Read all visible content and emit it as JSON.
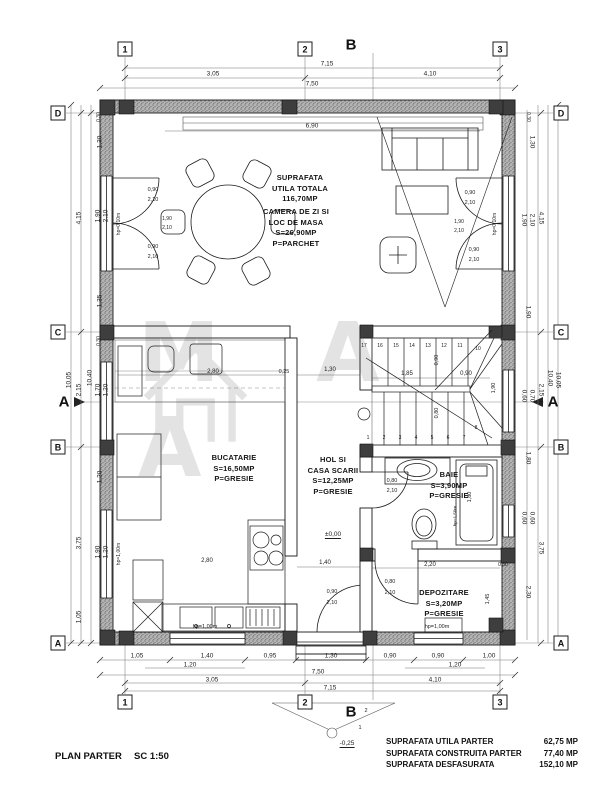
{
  "titleblock": {
    "plan_title": "PLAN PARTER",
    "scale_label": "SC 1:50"
  },
  "summary": {
    "rows": [
      {
        "label": "SUPRAFATA UTILA  PARTER",
        "value": "62,75 MP"
      },
      {
        "label": "SUPRAFATA CONSTRUITA  PARTER",
        "value": "77,40 MP"
      },
      {
        "label": "SUPRAFATA DESFASURATA",
        "value": "152,10 MP"
      }
    ]
  },
  "watermark": {
    "text": "M A A"
  },
  "rooms": [
    {
      "id": "total-area",
      "x": 300,
      "y": 173,
      "lines": [
        "SUPRAFATA",
        "UTILA TOTALA",
        "116,70MP"
      ]
    },
    {
      "id": "living",
      "x": 296,
      "y": 207,
      "lines": [
        "CAMERA DE ZI SI",
        "LOC DE MASA",
        "S=26,90MP",
        "P=PARCHET"
      ]
    },
    {
      "id": "kitchen",
      "x": 234,
      "y": 453,
      "lines": [
        "BUCATARIE",
        "S=16,50MP",
        "P=GRESIE"
      ]
    },
    {
      "id": "hall",
      "x": 333,
      "y": 455,
      "lines": [
        "HOL SI",
        "CASA SCARII",
        "S=12,25MP",
        "P=GRESIE"
      ]
    },
    {
      "id": "bathroom",
      "x": 449,
      "y": 470,
      "lines": [
        "BAIE",
        "S=3,90MP",
        "P=GRESIE"
      ]
    },
    {
      "id": "storage",
      "x": 444,
      "y": 588,
      "lines": [
        "DEPOZITARE",
        "S=3,20MP",
        "P=GRESIE"
      ]
    }
  ],
  "grid_markers": [
    {
      "t": "1",
      "x": 125,
      "y": 49
    },
    {
      "t": "2",
      "x": 305,
      "y": 49
    },
    {
      "t": "3",
      "x": 500,
      "y": 49
    },
    {
      "t": "1",
      "x": 125,
      "y": 702
    },
    {
      "t": "2",
      "x": 305,
      "y": 702
    },
    {
      "t": "3",
      "x": 500,
      "y": 702
    },
    {
      "t": "D",
      "x": 58,
      "y": 113
    },
    {
      "t": "C",
      "x": 58,
      "y": 332
    },
    {
      "t": "B",
      "x": 58,
      "y": 447
    },
    {
      "t": "A",
      "x": 58,
      "y": 643
    },
    {
      "t": "D",
      "x": 561,
      "y": 113
    },
    {
      "t": "C",
      "x": 561,
      "y": 332
    },
    {
      "t": "B",
      "x": 561,
      "y": 447
    },
    {
      "t": "A",
      "x": 561,
      "y": 643
    },
    {
      "t": "B",
      "x": 351,
      "y": 45,
      "bold": true
    },
    {
      "t": "B",
      "x": 351,
      "y": 712,
      "bold": true
    },
    {
      "t": "A",
      "x": 64,
      "y": 402,
      "bold": true
    },
    {
      "t": "A",
      "x": 553,
      "y": 402,
      "bold": true
    }
  ],
  "dim_labels": [
    {
      "t": "7,15",
      "x": 327,
      "y": 64
    },
    {
      "t": "3,05",
      "x": 213,
      "y": 74
    },
    {
      "t": "4,10",
      "x": 430,
      "y": 74
    },
    {
      "t": "7,50",
      "x": 312,
      "y": 84
    },
    {
      "t": "6,90",
      "x": 312,
      "y": 126
    },
    {
      "t": "1,05",
      "x": 137,
      "y": 656
    },
    {
      "t": "1,40",
      "x": 207,
      "y": 656
    },
    {
      "t": "0,95",
      "x": 270,
      "y": 656
    },
    {
      "t": "1,30",
      "x": 331,
      "y": 656
    },
    {
      "t": "0,90",
      "x": 390,
      "y": 656
    },
    {
      "t": "0,90",
      "x": 438,
      "y": 656
    },
    {
      "t": "1,00",
      "x": 489,
      "y": 656
    },
    {
      "t": "1,20",
      "x": 190,
      "y": 665
    },
    {
      "t": "1,20",
      "x": 455,
      "y": 665
    },
    {
      "t": "7,50",
      "x": 318,
      "y": 672
    },
    {
      "t": "3,05",
      "x": 212,
      "y": 680
    },
    {
      "t": "4,10",
      "x": 435,
      "y": 680
    },
    {
      "t": "7,15",
      "x": 330,
      "y": 688
    },
    {
      "t": "2",
      "x": 366,
      "y": 711,
      "s": 5.5
    },
    {
      "t": "1",
      "x": 360,
      "y": 728,
      "s": 5.5
    },
    {
      "t": "-0,25",
      "x": 347,
      "y": 744,
      "u": true
    },
    {
      "t": "10,05",
      "x": 69,
      "y": 380,
      "r": -90
    },
    {
      "t": "4,15",
      "x": 79,
      "y": 218,
      "r": -90
    },
    {
      "t": "2,15",
      "x": 79,
      "y": 390,
      "r": -90
    },
    {
      "t": "3,75",
      "x": 79,
      "y": 543,
      "r": -90
    },
    {
      "t": "1,05",
      "x": 79,
      "y": 617,
      "r": -90
    },
    {
      "t": "10,40",
      "x": 90,
      "y": 378,
      "r": -90
    },
    {
      "t": "1,30",
      "x": 100,
      "y": 142,
      "r": -90
    },
    {
      "t": "1,90",
      "x": 98,
      "y": 216,
      "r": -90
    },
    {
      "t": "2,10",
      "x": 106,
      "y": 216,
      "r": -90
    },
    {
      "t": "1,35",
      "x": 100,
      "y": 301,
      "r": -90
    },
    {
      "t": "1,70",
      "x": 98,
      "y": 390,
      "r": -90
    },
    {
      "t": "1,20",
      "x": 106,
      "y": 390,
      "r": -90
    },
    {
      "t": "1,20",
      "x": 100,
      "y": 477,
      "r": -90
    },
    {
      "t": "1,90",
      "x": 98,
      "y": 552,
      "r": -90
    },
    {
      "t": "1,20",
      "x": 106,
      "y": 552,
      "r": -90
    },
    {
      "t": "0,30",
      "x": 99,
      "y": 117,
      "r": -90,
      "s": 5
    },
    {
      "t": "0,30",
      "x": 99,
      "y": 341,
      "r": -90,
      "s": 5
    },
    {
      "t": "hp=0,10m",
      "x": 119,
      "y": 224,
      "r": -90,
      "s": 5
    },
    {
      "t": "hp=1,00m",
      "x": 119,
      "y": 554,
      "r": -90,
      "s": 5
    },
    {
      "t": "1,30",
      "x": 532,
      "y": 142,
      "r": 90
    },
    {
      "t": "1,90",
      "x": 524,
      "y": 220,
      "r": 90
    },
    {
      "t": "2,10",
      "x": 532,
      "y": 220,
      "r": 90
    },
    {
      "t": "1,90",
      "x": 528,
      "y": 312,
      "r": 90
    },
    {
      "t": "0,60",
      "x": 524,
      "y": 396,
      "r": 90
    },
    {
      "t": "0,70",
      "x": 532,
      "y": 396,
      "r": 90
    },
    {
      "t": "1,80",
      "x": 528,
      "y": 458,
      "r": 90
    },
    {
      "t": "0,60",
      "x": 524,
      "y": 518,
      "r": 90
    },
    {
      "t": "0,60",
      "x": 532,
      "y": 518,
      "r": 90
    },
    {
      "t": "2,30",
      "x": 528,
      "y": 592,
      "r": 90
    },
    {
      "t": "0,30",
      "x": 528,
      "y": 117,
      "r": 90,
      "s": 5
    },
    {
      "t": "4,15",
      "x": 541,
      "y": 218,
      "r": 90
    },
    {
      "t": "2,15",
      "x": 541,
      "y": 390,
      "r": 90
    },
    {
      "t": "3,75",
      "x": 541,
      "y": 548,
      "r": 90
    },
    {
      "t": "10,40",
      "x": 550,
      "y": 378,
      "r": 90
    },
    {
      "t": "10,05",
      "x": 558,
      "y": 380,
      "r": 90
    },
    {
      "t": "0,90",
      "x": 153,
      "y": 190,
      "s": 5.5
    },
    {
      "t": "2,10",
      "x": 153,
      "y": 200,
      "s": 5.5
    },
    {
      "t": "0,90",
      "x": 153,
      "y": 247,
      "s": 5.5
    },
    {
      "t": "2,10",
      "x": 153,
      "y": 257,
      "s": 5.5
    },
    {
      "t": "1,90",
      "x": 167,
      "y": 219,
      "s": 5
    },
    {
      "t": "2,10",
      "x": 167,
      "y": 228,
      "s": 5
    },
    {
      "t": "0,90",
      "x": 470,
      "y": 193,
      "s": 5.5
    },
    {
      "t": "2,10",
      "x": 470,
      "y": 203,
      "s": 5.5
    },
    {
      "t": "0,90",
      "x": 474,
      "y": 250,
      "s": 5.5
    },
    {
      "t": "2,10",
      "x": 474,
      "y": 260,
      "s": 5.5
    },
    {
      "t": "1,90",
      "x": 459,
      "y": 222,
      "s": 5
    },
    {
      "t": "2,10",
      "x": 459,
      "y": 231,
      "s": 5
    },
    {
      "t": "hp=0,10m",
      "x": 495,
      "y": 224,
      "r": -90,
      "s": 5
    },
    {
      "t": "2,80",
      "x": 213,
      "y": 372,
      "s": 6
    },
    {
      "t": "0,25",
      "x": 284,
      "y": 372,
      "s": 5.5
    },
    {
      "t": "1,30",
      "x": 330,
      "y": 370,
      "s": 6
    },
    {
      "t": "1,85",
      "x": 407,
      "y": 374,
      "s": 6
    },
    {
      "t": "0,90",
      "x": 466,
      "y": 374,
      "s": 6
    },
    {
      "t": "0,90",
      "x": 437,
      "y": 360,
      "r": -90,
      "s": 5.5
    },
    {
      "t": "0,80",
      "x": 437,
      "y": 413,
      "r": -90,
      "s": 5.5
    },
    {
      "t": "1,90",
      "x": 494,
      "y": 388,
      "r": -90,
      "s": 5.5
    },
    {
      "t": "±0,00",
      "x": 333,
      "y": 535,
      "u": true
    },
    {
      "t": "0,80",
      "x": 392,
      "y": 481,
      "s": 5.5
    },
    {
      "t": "2,10",
      "x": 392,
      "y": 491,
      "s": 5.5
    },
    {
      "t": "1,80",
      "x": 470,
      "y": 497,
      "r": -90,
      "s": 5.5
    },
    {
      "t": "hp=1,50m",
      "x": 455,
      "y": 516,
      "r": -90,
      "s": 4.5
    },
    {
      "t": "2,20",
      "x": 430,
      "y": 565,
      "s": 6
    },
    {
      "t": "0,30",
      "x": 503,
      "y": 565,
      "s": 5
    },
    {
      "t": "1,45",
      "x": 488,
      "y": 599,
      "r": -90,
      "s": 5.5
    },
    {
      "t": "0,80",
      "x": 390,
      "y": 582,
      "s": 5.5
    },
    {
      "t": "2,10",
      "x": 390,
      "y": 593,
      "s": 5.5
    },
    {
      "t": "hp=1,00m",
      "x": 437,
      "y": 627,
      "s": 5.5
    },
    {
      "t": "1,40",
      "x": 325,
      "y": 563,
      "s": 6
    },
    {
      "t": "0,90",
      "x": 332,
      "y": 592,
      "s": 5.5
    },
    {
      "t": "2,10",
      "x": 332,
      "y": 603,
      "s": 5.5
    },
    {
      "t": "2,80",
      "x": 207,
      "y": 561,
      "s": 6
    },
    {
      "t": "hp=1,00m",
      "x": 205,
      "y": 627,
      "s": 5.5
    },
    {
      "t": "17",
      "x": 364,
      "y": 346,
      "s": 5
    },
    {
      "t": "16",
      "x": 380,
      "y": 346,
      "s": 5
    },
    {
      "t": "15",
      "x": 396,
      "y": 346,
      "s": 5
    },
    {
      "t": "14",
      "x": 412,
      "y": 346,
      "s": 5
    },
    {
      "t": "13",
      "x": 428,
      "y": 346,
      "s": 5
    },
    {
      "t": "12",
      "x": 444,
      "y": 346,
      "s": 5
    },
    {
      "t": "11",
      "x": 460,
      "y": 346,
      "s": 5
    },
    {
      "t": "10",
      "x": 478,
      "y": 349,
      "s": 5
    },
    {
      "t": "1",
      "x": 368,
      "y": 438,
      "s": 5
    },
    {
      "t": "2",
      "x": 384,
      "y": 438,
      "s": 5
    },
    {
      "t": "3",
      "x": 400,
      "y": 438,
      "s": 5
    },
    {
      "t": "4",
      "x": 416,
      "y": 438,
      "s": 5
    },
    {
      "t": "5",
      "x": 432,
      "y": 438,
      "s": 5
    },
    {
      "t": "6",
      "x": 448,
      "y": 438,
      "s": 5
    },
    {
      "t": "7",
      "x": 464,
      "y": 438,
      "s": 5
    },
    {
      "t": "8",
      "x": 476,
      "y": 428,
      "s": 5
    }
  ]
}
